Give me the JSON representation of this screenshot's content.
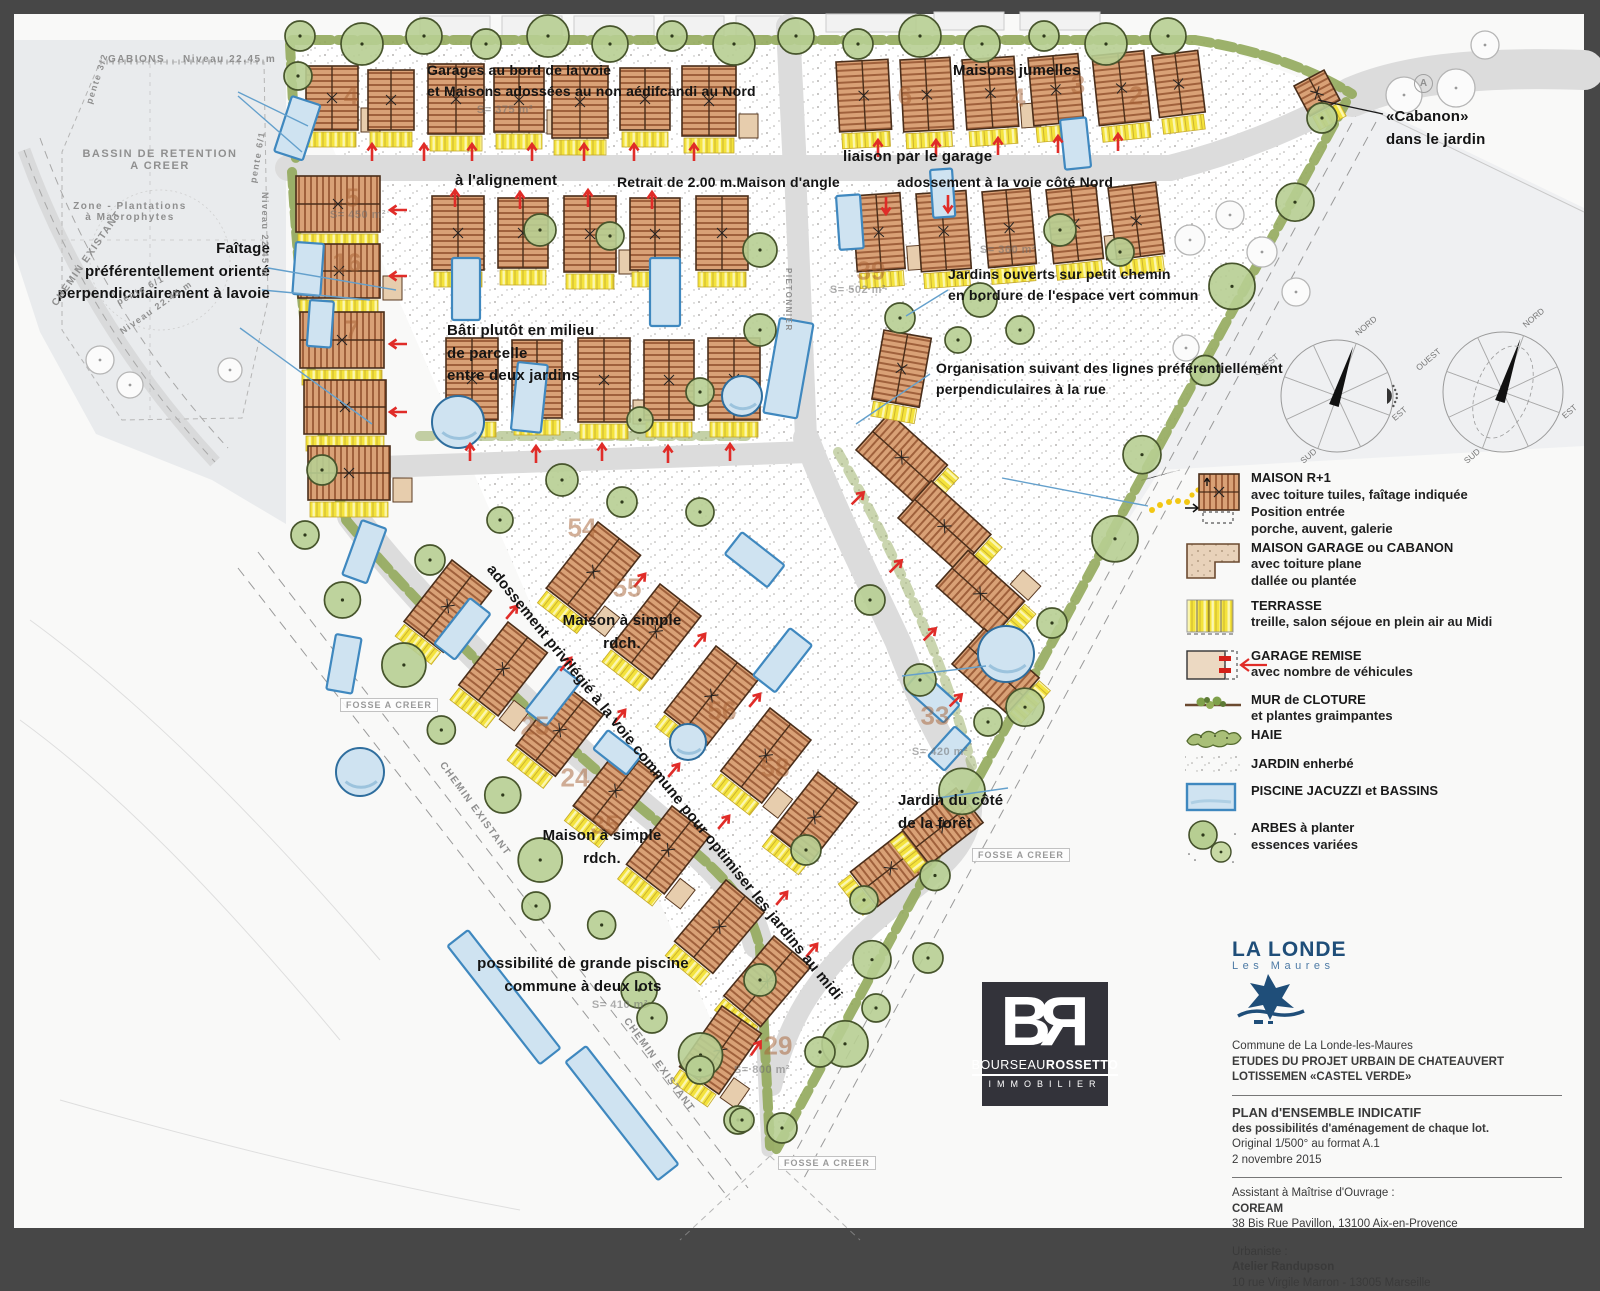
{
  "map": {
    "annotations": [
      {
        "text": "Garages au bord de la voie\net Maisons adossées au non aédifcandi au Nord",
        "x": 427,
        "y": 60,
        "size": 14
      },
      {
        "text": "à l'alignement",
        "x": 455,
        "y": 170,
        "size": 15
      },
      {
        "text": "Retrait de 2.00 m.Maison d'angle",
        "x": 617,
        "y": 172,
        "size": 14
      },
      {
        "text": "Maisons jumelles",
        "x": 953,
        "y": 60,
        "size": 15
      },
      {
        "text": "liaison par le garage",
        "x": 843,
        "y": 146,
        "size": 15
      },
      {
        "text": "adossement à la voie côté Nord",
        "x": 897,
        "y": 172,
        "size": 14
      },
      {
        "text": "«Cabanon»\ndans le jardin",
        "x": 1386,
        "y": 106,
        "size": 15
      },
      {
        "text": "Jardins ouverts sur petit chemin\nen bordure de l'espace vert commun",
        "x": 948,
        "y": 264,
        "size": 14
      },
      {
        "text": "Faîtage\npréférentellement orienté\nperpendiculairement à lavoie",
        "x": 270,
        "y": 238,
        "size": 15,
        "align": "right"
      },
      {
        "text": "Bâti plutôt en milieu\nde parcelle\nentre deux jardins",
        "x": 447,
        "y": 320,
        "size": 15
      },
      {
        "text": "Organisation suivant des lignes préférentiellement\nperpendiculaires à la rue",
        "x": 936,
        "y": 358,
        "size": 14
      },
      {
        "text": "Maison à simple\nrdch.",
        "x": 622,
        "y": 610,
        "size": 15,
        "align": "center"
      },
      {
        "text": "Maison à simple\nrdch.",
        "x": 602,
        "y": 825,
        "size": 15,
        "align": "center"
      },
      {
        "text": "Jardin du côté\nde la forêt",
        "x": 898,
        "y": 790,
        "size": 15
      },
      {
        "text": "possibilité de grande piscine\ncommune à deux lots",
        "x": 583,
        "y": 953,
        "size": 15,
        "align": "center"
      },
      {
        "text": "adossement privilégié à la voie commune pour optimiser les jardins au midi",
        "x": 498,
        "y": 560,
        "size": 15,
        "rotate": 51
      }
    ],
    "context_labels": [
      {
        "text": "GABIONS",
        "x": 108,
        "y": 54,
        "size": 10
      },
      {
        "text": "Niveau 22.45 m",
        "x": 183,
        "y": 54,
        "size": 10
      },
      {
        "text": "BASSIN DE RETENTION\nA CREER",
        "x": 160,
        "y": 148,
        "size": 11,
        "align": "center"
      },
      {
        "text": "Zone - Plantations\nà Macrophytes",
        "x": 130,
        "y": 201,
        "size": 10,
        "align": "center"
      },
      {
        "text": "pente 3/2",
        "x": 84,
        "y": 102,
        "size": 9,
        "rotate": -72
      },
      {
        "text": "pente 6/1",
        "x": 248,
        "y": 182,
        "size": 9,
        "rotate": -80
      },
      {
        "text": "pente 6/1",
        "x": 115,
        "y": 298,
        "size": 9,
        "rotate": -28
      },
      {
        "text": "Niveau 22.45 m",
        "x": 118,
        "y": 328,
        "size": 9,
        "rotate": -35
      },
      {
        "text": "Niveau 22.45 m",
        "x": 270,
        "y": 192,
        "size": 9,
        "rotate": 90
      },
      {
        "text": "CHEMIN EXISTANT",
        "x": 50,
        "y": 302,
        "size": 10,
        "rotate": -55
      },
      {
        "text": "CHEMIN EXISTANT",
        "x": 446,
        "y": 760,
        "size": 10,
        "rotate": 54
      },
      {
        "text": "CHEMIN EXISTANT",
        "x": 630,
        "y": 1016,
        "size": 10,
        "rotate": 54
      },
      {
        "text": "PIETONNIER",
        "x": 793,
        "y": 268,
        "size": 8,
        "rotate": 90
      }
    ],
    "fosse_labels": [
      {
        "text": "FOSSE A CREER",
        "x": 340,
        "y": 698
      },
      {
        "text": "FOSSE A CREER",
        "x": 972,
        "y": 848
      },
      {
        "text": "FOSSE A CREER",
        "x": 778,
        "y": 1156
      }
    ],
    "lot_numbers": [
      {
        "n": "4",
        "x": 351,
        "y": 96
      },
      {
        "n": "6",
        "x": 905,
        "y": 96
      },
      {
        "n": "4",
        "x": 1018,
        "y": 98
      },
      {
        "n": "3",
        "x": 1078,
        "y": 85
      },
      {
        "n": "2",
        "x": 1136,
        "y": 96
      },
      {
        "n": "5",
        "x": 352,
        "y": 198
      },
      {
        "n": "16",
        "x": 347,
        "y": 263
      },
      {
        "n": "7",
        "x": 352,
        "y": 330
      },
      {
        "n": "39",
        "x": 871,
        "y": 271
      },
      {
        "n": "54",
        "x": 582,
        "y": 528
      },
      {
        "n": "55",
        "x": 627,
        "y": 588
      },
      {
        "n": "56",
        "x": 722,
        "y": 711
      },
      {
        "n": "58",
        "x": 775,
        "y": 768
      },
      {
        "n": "25",
        "x": 535,
        "y": 726
      },
      {
        "n": "24",
        "x": 575,
        "y": 778
      },
      {
        "n": "35",
        "x": 605,
        "y": 825
      },
      {
        "n": "29",
        "x": 778,
        "y": 1046
      },
      {
        "n": "33",
        "x": 935,
        "y": 716
      }
    ],
    "area_labels": [
      {
        "text": "S= 375 m²",
        "x": 505,
        "y": 110
      },
      {
        "text": "S= 450 m²",
        "x": 358,
        "y": 215
      },
      {
        "text": "S= 502 m²",
        "x": 858,
        "y": 290
      },
      {
        "text": "S= 360 m²",
        "x": 1008,
        "y": 250
      },
      {
        "text": "S= 800 m²",
        "x": 762,
        "y": 1070
      },
      {
        "text": "S= 410 m²",
        "x": 620,
        "y": 1005
      },
      {
        "text": "S= 420 m²",
        "x": 940,
        "y": 752
      }
    ],
    "road_marker": {
      "label": "A",
      "x": 1414,
      "y": 74
    }
  },
  "legend": {
    "items": [
      {
        "icon": "maison_r1",
        "title": "MAISON R+1",
        "lines": [
          "avec toiture tuiles, faîtage indiquée",
          "Position entrée",
          "porche, auvent, galerie"
        ]
      },
      {
        "icon": "maison_garage",
        "title": "MAISON GARAGE ou CABANON",
        "lines": [
          "avec toiture plane",
          "dallée ou plantée"
        ]
      },
      {
        "icon": "terrasse",
        "title": "TERRASSE",
        "lines": [
          "treille, salon séjoue en plein air au Midi"
        ]
      },
      {
        "icon": "garage_remise",
        "title": "GARAGE REMISE",
        "lines": [
          "avec nombre de véhicules"
        ]
      },
      {
        "icon": "mur_cloture",
        "title": "MUR de CLOTURE",
        "lines": [
          "et plantes graimpantes"
        ]
      },
      {
        "icon": "haie",
        "title": "HAIE",
        "lines": []
      },
      {
        "icon": "jardin",
        "title": "JARDIN enherbé",
        "lines": []
      },
      {
        "icon": "piscine",
        "title": "PISCINE JACUZZI et BASSINS",
        "lines": []
      },
      {
        "icon": "arbres",
        "title": "ARBES à planter",
        "lines": [
          "essences variées"
        ]
      }
    ]
  },
  "compass": {
    "labels": {
      "n": "NORD",
      "w": "OUEST",
      "e": "EST",
      "s": "SUD"
    }
  },
  "br_logo": {
    "b": "B",
    "r": "R",
    "name1": "Bourseau",
    "name2": "Rossetto",
    "sub": "IMMOBILIER"
  },
  "title_block": {
    "logo_line1": "LA LONDE",
    "logo_line2": "Les Maures",
    "commune": "Commune  de La Londe-les-Maures",
    "project": "ETUDES DU PROJET URBAIN DE CHATEAUVERT",
    "lotissement": "LOTISSEMEN «CASTEL VERDE»",
    "plan_title": "PLAN d'ENSEMBLE INDICATIF",
    "plan_sub": "des possibilités d'aménagement de chaque lot.",
    "original": "Original 1/500° au format A.1",
    "date": "2 novembre 2015",
    "amo_label": "Assistant à Maîtrise d'Ouvrage :",
    "amo_name": "COREAM",
    "amo_addr": "38 Bis Rue Pavillon, 13100 Aix-en-Provence",
    "urb_label": "Urbaniste :",
    "urb_name": "Atelier Randupson",
    "urb_addr": "10 rue Virgile Marron - 13005 Marseille"
  },
  "colors": {
    "frame": "#474747",
    "paper": "#f9f9f8",
    "road": "#dcdcdc",
    "roof": "#d9a176",
    "roof_line": "#a0613c",
    "terrace": "#f4e33c",
    "tree": "#b7ce92",
    "tree_line": "#47552c",
    "pool": "#cfe3f1",
    "pool_line": "#3f88bf",
    "hedge": "#93aa5c",
    "arrow_red": "#e02c28",
    "leader_blue": "#64a0cc",
    "navy": "#1f4e79"
  }
}
